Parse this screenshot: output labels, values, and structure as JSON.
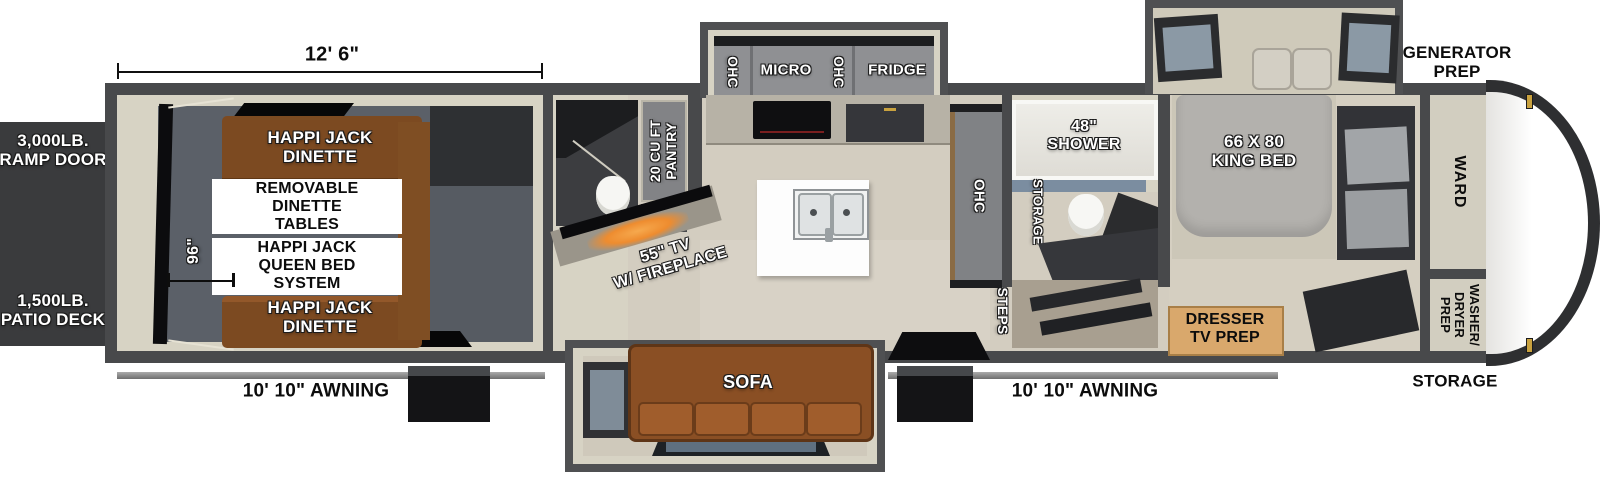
{
  "diagram": {
    "title": "travel-trailer-toy-hauler-floorplan-top-view",
    "exterior": {
      "garage_width_dim": "12' 6\"",
      "garage_interior_dim": "96\"",
      "generator_prep": "GENERATOR\nPREP",
      "ramp_door": "3,000LB.\nRAMP DOOR",
      "patio_deck": "1,500LB.\nPATIO DECK",
      "awning_left": "10' 10\" AWNING",
      "awning_right": "10' 10\" AWNING",
      "front_storage": "STORAGE"
    },
    "garage": {
      "dinette_front": "HAPPI JACK\nDINETTE",
      "dinette_rear": "HAPPI JACK\nDINETTE",
      "removable_tables": "REMOVABLE\nDINETTE\nTABLES",
      "queen_bed_system": "HAPPI JACK\nQUEEN BED\nSYSTEM"
    },
    "kitchen": {
      "pantry": "20 CU FT\nPANTRY",
      "ohc_left": "OHC",
      "micro": "MICRO",
      "ohc_mid": "OHC",
      "fridge": "FRIDGE",
      "ohc_wall": "OHC",
      "tv_fireplace": "55\" TV\nW/ FIREPLACE"
    },
    "living": {
      "sofa": "SOFA",
      "steps": "STEPS"
    },
    "bathroom": {
      "shower": "48\"\nSHOWER",
      "storage": "STORAGE"
    },
    "bedroom": {
      "king_bed": "66 X 80\nKING BED",
      "dresser": "DRESSER\nTV PREP",
      "ward": "WARD",
      "washer_dryer": "WASHER/\nDRYER\nPREP"
    }
  },
  "colors": {
    "wall": "#48494b",
    "lining": "#d7d3c4",
    "floor_living": "#d3cdc0",
    "floor_garage": "#5b6068",
    "exterior_block": "#3a3b3d",
    "wood_dinette": "#7c4a21",
    "sofa": "#9c5b2b",
    "dresser_wood": "#d9a86c",
    "fireplace_glow": "#f0923b",
    "window_glass": "#8b99a5",
    "cabinet_gray": "#8f9093"
  }
}
